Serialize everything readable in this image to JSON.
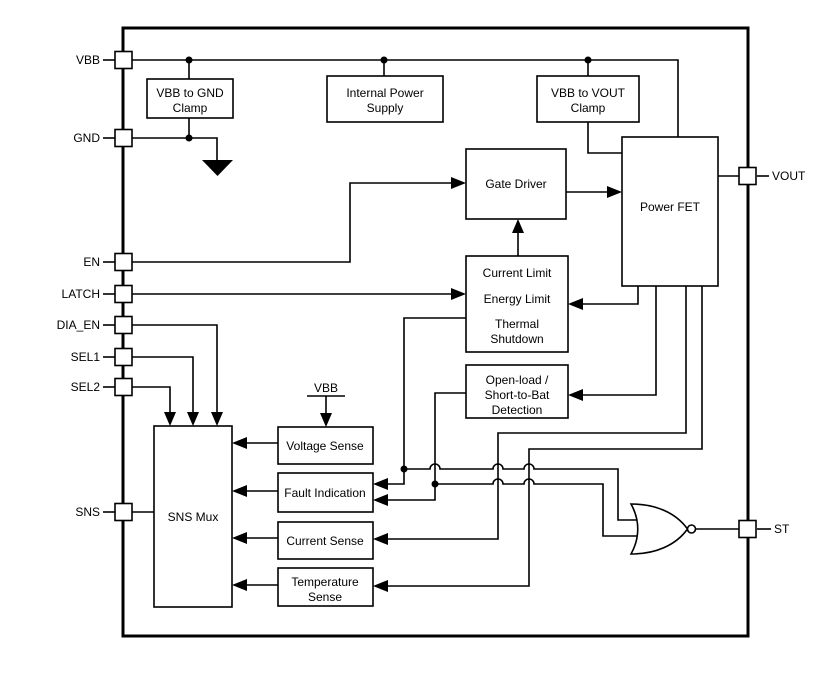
{
  "title": "Power switch functional block diagram",
  "colors": {
    "line": "#000000",
    "background": "#ffffff",
    "block_fill": "#ffffff"
  },
  "pins": {
    "vbb": {
      "label": "VBB"
    },
    "gnd": {
      "label": "GND"
    },
    "en": {
      "label": "EN"
    },
    "latch": {
      "label": "LATCH"
    },
    "dia_en": {
      "label": "DIA_EN"
    },
    "sel1": {
      "label": "SEL1"
    },
    "sel2": {
      "label": "SEL2"
    },
    "sns": {
      "label": "SNS"
    },
    "vout": {
      "label": "VOUT"
    },
    "st": {
      "label": "ST"
    }
  },
  "blocks": {
    "vbb_gnd_clamp": {
      "lines": [
        "VBB to GND",
        "Clamp"
      ]
    },
    "internal_power_supply": {
      "lines": [
        "Internal Power",
        "Supply"
      ]
    },
    "vbb_vout_clamp": {
      "lines": [
        "VBB to VOUT",
        "Clamp"
      ]
    },
    "gate_driver": {
      "label": "Gate Driver"
    },
    "power_fet": {
      "label": "Power FET"
    },
    "protection": {
      "lines": [
        "Current Limit",
        "Energy Limit",
        "Thermal",
        "Shutdown"
      ]
    },
    "open_load_detection": {
      "lines": [
        "Open-load /",
        "Short-to-Bat",
        "Detection"
      ]
    },
    "sns_mux": {
      "label": "SNS Mux"
    },
    "voltage_sense": {
      "label": "Voltage Sense"
    },
    "fault_indication": {
      "label": "Fault Indication"
    },
    "current_sense": {
      "label": "Current Sense"
    },
    "temperature_sense": {
      "lines": [
        "Temperature",
        "Sense"
      ]
    }
  },
  "annotations": {
    "vbb_rail_label": "VBB"
  }
}
